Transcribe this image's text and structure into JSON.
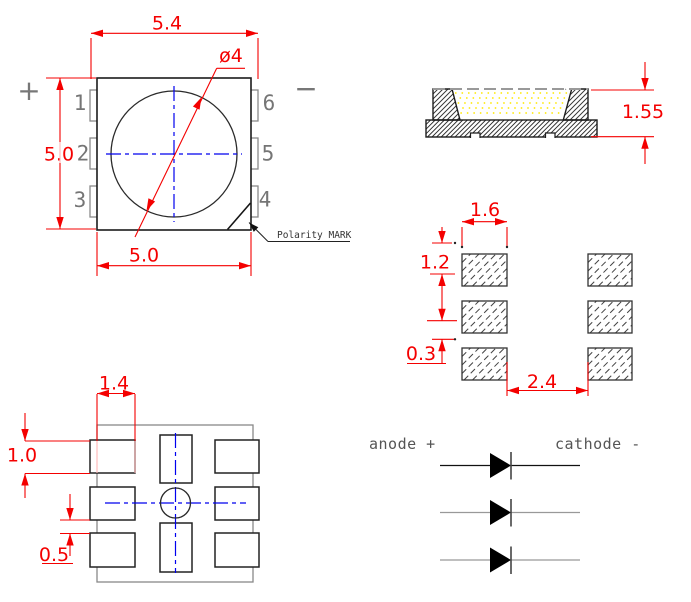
{
  "top_view": {
    "dim_overall_width": "5.4",
    "dim_body_height": "5.0",
    "dim_body_width": "5.0",
    "dim_lens_diameter": "ø4",
    "pin_labels_left": [
      "1",
      "2",
      "3"
    ],
    "pin_labels_right": [
      "6",
      "5",
      "4"
    ],
    "polarity_symbol_plus": "+",
    "polarity_symbol_minus": "−",
    "polarity_mark_label": "Polarity MARK"
  },
  "side_view": {
    "dim_height": "1.55"
  },
  "solder_pad_layout": {
    "dim_pad_width": "1.6",
    "dim_pad_pitch": "1.2",
    "dim_pad_gap": "0.3",
    "dim_column_gap": "2.4"
  },
  "bottom_view": {
    "dim_pad_width": "1.4",
    "dim_pad_height": "1.0",
    "dim_pad_gap": "0.5"
  },
  "circuit_diagram": {
    "anode_label": "anode +",
    "cathode_label": "cathode -",
    "diode_count": 3
  },
  "colors": {
    "dimension_red": "#f40000",
    "centerline_blue": "#0000ee",
    "outline_dark": "#1c1c1c",
    "secondary_gray": "#808080",
    "phosphor_yellow": "#ffe800",
    "background": "#ffffff"
  }
}
